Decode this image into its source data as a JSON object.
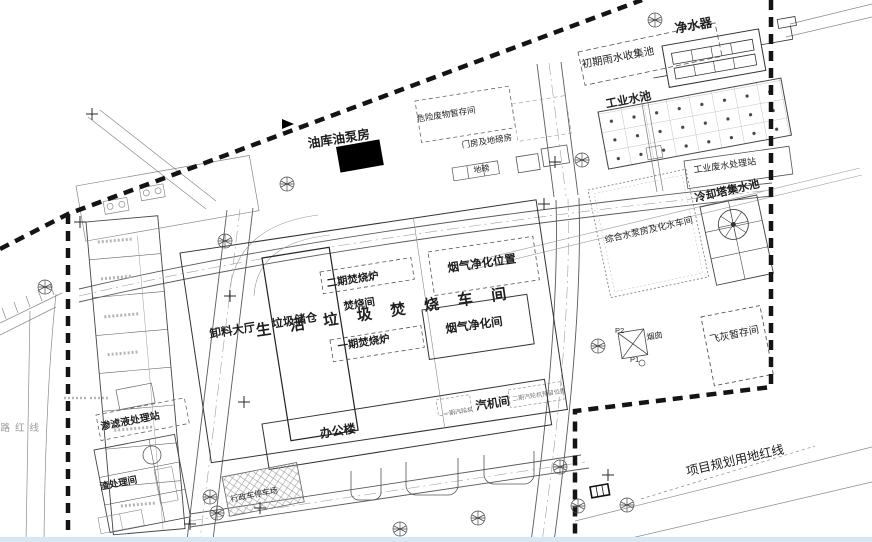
{
  "labels": {
    "water_purifier": "净水器",
    "initial_rainwater_pool": "初期雨水收集池",
    "industrial_water_pool": "工业水池",
    "industrial_wastewater_station": "工业废水处理站",
    "cooling_tower_pool": "冷却塔集水池",
    "pump_house_water_workshop": "综合水泵房及化水车间",
    "oil_depot_pump_house": "油库油泵房",
    "hazardous_waste_storage": "危险废物暂存间",
    "gatehouse_weighbridge": "门房及地磅房",
    "weighbridge": "地磅",
    "flue_gas_purification_position": "烟气净化位置",
    "flue_gas_purification_room": "烟气净化间",
    "phase2_incinerator": "二期焚烧炉",
    "incineration_room": "焚烧间",
    "main_workshop": "生活垃圾焚烧车间",
    "phase1_incinerator": "一期焚烧炉",
    "waste_bunker": "垃圾储仓",
    "unloading_hall": "卸料大厅",
    "turbine_room": "汽机间",
    "phase1_turbine": "一期汽轮机",
    "phase2_turbine_reserved": "二期汽轮机预留位置",
    "office_building": "办公楼",
    "admin_parking": "行政车停车场",
    "leachate_station": "渗滤液处理站",
    "slag_treatment_room": "渣处理间",
    "fly_ash_storage": "飞灰暂存间",
    "chimney": "烟囱",
    "p1": "P1",
    "p2": "P2",
    "planning_red_line": "项目规划用地红线",
    "road_red_line": "道路红线"
  },
  "colors": {
    "paper": "#ffffff",
    "line": "#3c3c3c",
    "boundary": "#141414",
    "solid_building": "#000000",
    "bottom_strip": "#d9e6f4"
  }
}
